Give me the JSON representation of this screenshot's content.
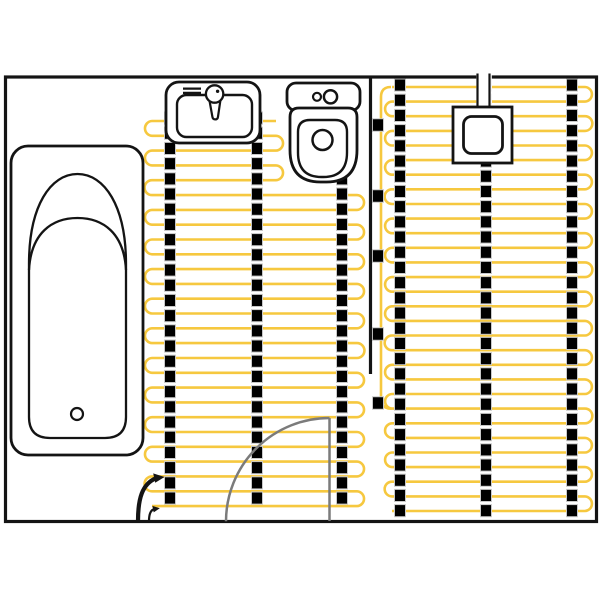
{
  "canvas": {
    "width": 600,
    "height": 600,
    "background": "#ffffff"
  },
  "colors": {
    "cable": "#F6C83F",
    "ink": "#141414",
    "strip_fill": "#000000",
    "strip_edge": "#c9c9c9",
    "door": "#7b7b7b",
    "white": "#ffffff"
  },
  "room": {
    "x": 5.5,
    "y": 77,
    "width": 591,
    "height": 444.5,
    "stroke_width": 3.2
  },
  "partition": {
    "x": 370.5,
    "y0": 77,
    "y1": 374,
    "stroke_width": 3.2
  },
  "cable_zones": [
    {
      "name": "heating-cable-left-zone",
      "y0": 121,
      "dy": 14.81,
      "count": 27,
      "x_left": 152,
      "x_right_narrow": 276,
      "x_right_wide": 357,
      "narrow_max_k": 4,
      "start_side": "right",
      "stroke_width": 2.6
    },
    {
      "name": "heating-cable-right-zone",
      "y0": 87,
      "dy": 14.62,
      "count": 30,
      "x_left": 392,
      "x_right_narrow": 585,
      "x_right_wide": 585,
      "narrow_max_k": -1,
      "start_side": "left",
      "stroke_width": 2.6
    }
  ],
  "feed_line": {
    "name": "sensor-feed-cable",
    "d": "M 391 87 Q 381 87 381 97 L 381 398.5 Q 381 408.7 391.5 408.7",
    "stroke_width": 2.6
  },
  "strip_style": {
    "width": 11,
    "dash": 12.1,
    "gap": 3.1
  },
  "strips": [
    {
      "x": 170,
      "y0": 112,
      "y1": 517
    },
    {
      "x": 257,
      "y0": 112,
      "y1": 517
    },
    {
      "x": 342,
      "y0": 112,
      "y1": 517
    },
    {
      "x": 400,
      "y0": 79,
      "y1": 517
    },
    {
      "x": 486,
      "y0": 79,
      "y1": 517
    },
    {
      "x": 572,
      "y0": 79,
      "y1": 517
    }
  ],
  "clip_style": {
    "width": 11,
    "height": 12.5
  },
  "clips": [
    {
      "x": 378,
      "y": 125
    },
    {
      "x": 378,
      "y": 196
    },
    {
      "x": 378,
      "y": 256
    },
    {
      "x": 378,
      "y": 334
    },
    {
      "x": 378,
      "y": 403
    }
  ],
  "fixtures": [
    {
      "name": "bathtub-outer",
      "type": "rect",
      "x": 11,
      "y": 146,
      "w": 132,
      "h": 309,
      "rx": 17,
      "fill": "#ffffff",
      "sw": 2.8
    },
    {
      "name": "bathtub-inner",
      "type": "path",
      "d": "M 29 264 C 29 206 50.5 174 77.5 174 C 104.5 174 126 206 126 264 L 126 417 Q 126 438 105 438 L 50 438 Q 29 438 29 417 Z",
      "fill": "#ffffff",
      "sw": 2.3
    },
    {
      "name": "bathtub-backrest-arc",
      "type": "path",
      "d": "M 29 270 C 31 233 52 218 77.5 218 C 103 218 124 233 126 270",
      "fill": "none",
      "sw": 2.3
    },
    {
      "name": "bathtub-drain",
      "type": "circle",
      "cx": 77,
      "cy": 414,
      "r": 6,
      "fill": "#ffffff",
      "sw": 2.2
    },
    {
      "name": "sink-outer",
      "type": "rect",
      "x": 166,
      "y": 82,
      "w": 94,
      "h": 61,
      "rx": 13,
      "fill": "#ffffff",
      "sw": 2.8
    },
    {
      "name": "sink-basin",
      "type": "rect",
      "x": 177,
      "y": 95,
      "w": 75,
      "h": 42,
      "rx": 9.5,
      "fill": "#ffffff",
      "sw": 2.4
    },
    {
      "name": "sink-shelf-bar-1",
      "type": "line",
      "x1": 183,
      "y1": 88.6,
      "x2": 201,
      "y2": 88.6,
      "sw": 2.2
    },
    {
      "name": "sink-shelf-bar-2",
      "type": "line",
      "x1": 183,
      "y1": 92.9,
      "x2": 201,
      "y2": 92.9,
      "sw": 2.2
    },
    {
      "name": "faucet-stem",
      "type": "path",
      "d": "M 209.2 99 L 212.4 116.8 Q 212.8 119.4 215.2 119.4 Q 217.7 119.4 218 116.7 L 220.6 99 Z",
      "fill": "#ffffff",
      "sw": 2.2
    },
    {
      "name": "faucet-head",
      "type": "circle",
      "cx": 214.6,
      "cy": 94,
      "r": 8.7,
      "fill": "#ffffff",
      "sw": 2.3
    },
    {
      "name": "faucet-dot",
      "type": "circle",
      "cx": 217.6,
      "cy": 91.3,
      "r": 1.7,
      "fill": "#141414",
      "sw": 0
    },
    {
      "name": "toilet-tank",
      "type": "rect",
      "x": 287,
      "y": 83,
      "w": 73,
      "h": 27.5,
      "rx": 9,
      "fill": "#ffffff",
      "sw": 2.8
    },
    {
      "name": "toilet-button-small",
      "type": "circle",
      "cx": 317,
      "cy": 96.8,
      "r": 4,
      "fill": "#ffffff",
      "sw": 2.2
    },
    {
      "name": "toilet-button-large",
      "type": "circle",
      "cx": 330.5,
      "cy": 96.8,
      "r": 6.6,
      "fill": "#ffffff",
      "sw": 2.5
    },
    {
      "name": "toilet-bowl-outer",
      "type": "path",
      "d": "M 299 108 L 348 108 Q 357 108 357 117 L 357 150 Q 357 182 326.5 182 L 320.5 182 Q 290 182 290 150 L 290 117 Q 290 108 299 108 Z",
      "fill": "#ffffff",
      "sw": 2.8
    },
    {
      "name": "toilet-bowl-inner",
      "type": "path",
      "d": "M 310 120 L 335 120 Q 347 120 347 132 L 347 152.5 Q 347 177 323.5 177 L 321.5 177 Q 298 177 298 152.5 L 298 132 Q 298 120 310 120 Z",
      "fill": "#ffffff",
      "sw": 2.4
    },
    {
      "name": "toilet-flush-hole",
      "type": "circle",
      "cx": 322.5,
      "cy": 140,
      "r": 10,
      "fill": "#ffffff",
      "sw": 2.5
    },
    {
      "name": "conduit-fill",
      "type": "rect",
      "x": 476.3,
      "y": 73,
      "w": 15.5,
      "h": 36,
      "rx": 0,
      "fill": "#ffffff",
      "sw": 0
    },
    {
      "name": "conduit-side-left",
      "type": "line",
      "x1": 477.5,
      "y1": 73.5,
      "x2": 477.5,
      "y2": 108,
      "sw": 2.2
    },
    {
      "name": "conduit-side-right",
      "type": "line",
      "x1": 489.5,
      "y1": 73.5,
      "x2": 489.5,
      "y2": 108,
      "sw": 2.2
    },
    {
      "name": "junction-box-outer",
      "type": "rect",
      "x": 453,
      "y": 107,
      "w": 59,
      "h": 56,
      "rx": 0,
      "fill": "#ffffff",
      "sw": 2.8
    },
    {
      "name": "junction-box-inner",
      "type": "rect",
      "x": 463.5,
      "y": 116.5,
      "w": 39,
      "h": 37,
      "rx": 8,
      "fill": "#ffffff",
      "sw": 2.8
    }
  ],
  "tails": [
    {
      "name": "power-lead-arrow",
      "d": "M 138 521 C 138 499 142 484 156 478.2",
      "sw": 4.2,
      "head": "M 164.5 477 L 153.2 473.4 L 155.2 482.8 Z"
    },
    {
      "name": "sensor-lead-arrow",
      "d": "M 149 521 C 149 513.5 151 509.8 154.5 509",
      "sw": 2.2,
      "head": "M 159.8 508.3 L 152.4 505.9 L 153.7 512.4 Z"
    }
  ],
  "door": {
    "leaf": "M 329.5 418 L 329.5 521",
    "arc": "M 329.5 418 A 103.5 103.5 0 0 0 226 521.3",
    "stroke_width": 2.5
  }
}
